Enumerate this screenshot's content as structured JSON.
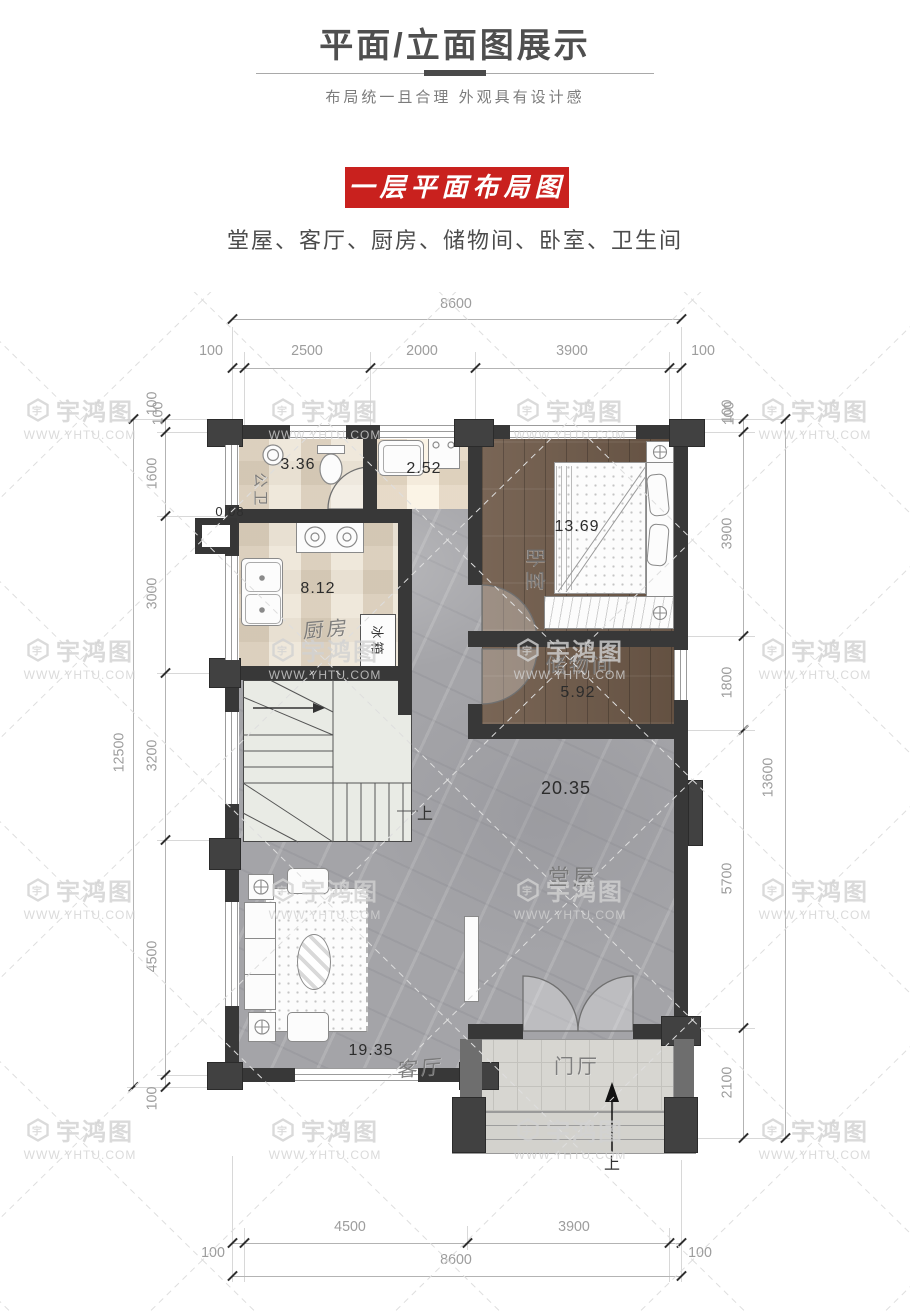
{
  "header": {
    "title": "平面/立面图展示",
    "subtitle": "布局统一且合理  外观具有设计感"
  },
  "banner": {
    "label": "一层平面布局图"
  },
  "rooms_line": "堂屋、客厅、厨房、储物间、卧室、卫生间",
  "watermark": {
    "brand": "宇鸿图",
    "url": "WWW.YHTU.COM"
  },
  "colors": {
    "banner_red": "#c9211e",
    "wall": "#383838",
    "wood_floor": "#6f5a49",
    "marble_floor": "#a4a4a8"
  },
  "plan": {
    "rooms": {
      "bathroom": {
        "name": "公卫",
        "area": "3.36"
      },
      "laundry": {
        "area": "2.52"
      },
      "bedroom": {
        "name": "卧室",
        "area": "13.69"
      },
      "kitchen": {
        "name": "厨房",
        "area": "8.12"
      },
      "storage": {
        "name": "储物间",
        "area": "5.92"
      },
      "hall": {
        "name": "堂屋",
        "area": "20.35"
      },
      "living": {
        "name": "客厅",
        "area": "19.35"
      },
      "foyer": {
        "name": "门厅"
      },
      "flue": {
        "area": "0.08"
      }
    },
    "labels": {
      "fridge": "冰箱",
      "stairs_up": "上",
      "entry_up": "上"
    }
  },
  "dimensions": {
    "top": {
      "overall": "8600",
      "segments": [
        "100",
        "2500",
        "2000",
        "3900",
        "100"
      ]
    },
    "left": {
      "overall": "12500",
      "segments": [
        "100",
        "1600",
        "3000",
        "3200",
        "4500",
        "100"
      ]
    },
    "right": {
      "overall": "13600",
      "segments": [
        "100",
        "3900",
        "1800",
        "5700",
        "2100"
      ]
    },
    "bottom": {
      "overall": "8600",
      "segments": [
        "4500",
        "3900"
      ],
      "left": "100",
      "right": "100"
    }
  }
}
